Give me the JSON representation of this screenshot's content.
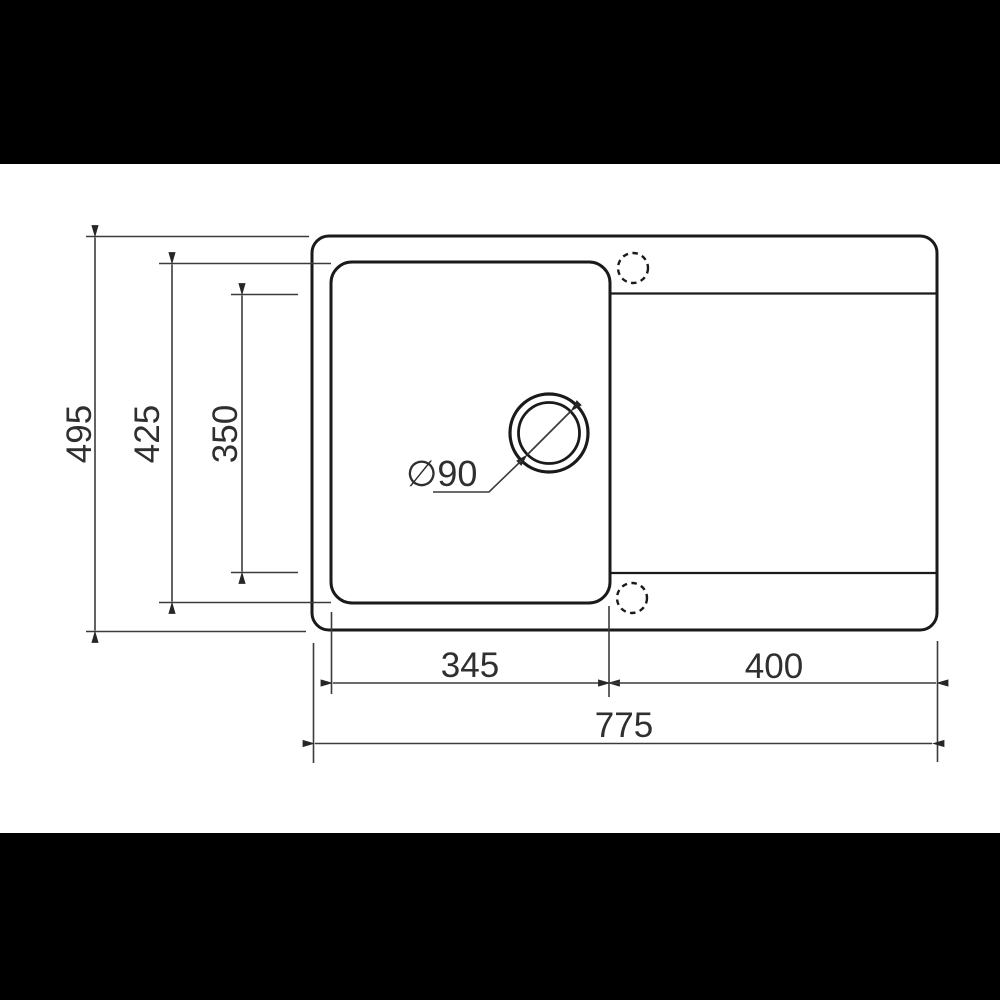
{
  "drawing": {
    "type": "technical-drawing",
    "subject": "kitchen sink with bowl and drainer, top view",
    "unit": "mm",
    "dimensions": {
      "overall_depth": "495",
      "bowl_outer_depth": "425",
      "bowl_inner_depth": "350",
      "bowl_width": "345",
      "drainer_width": "400",
      "overall_width": "775",
      "drain_diameter": "∅90"
    },
    "colors": {
      "letterbox": "#000000",
      "canvas": "#ffffff",
      "outline": "#1a1a1a",
      "dimension_line": "#3c3c3c",
      "arrow": "#262626",
      "text": "#2f2f2f"
    }
  }
}
